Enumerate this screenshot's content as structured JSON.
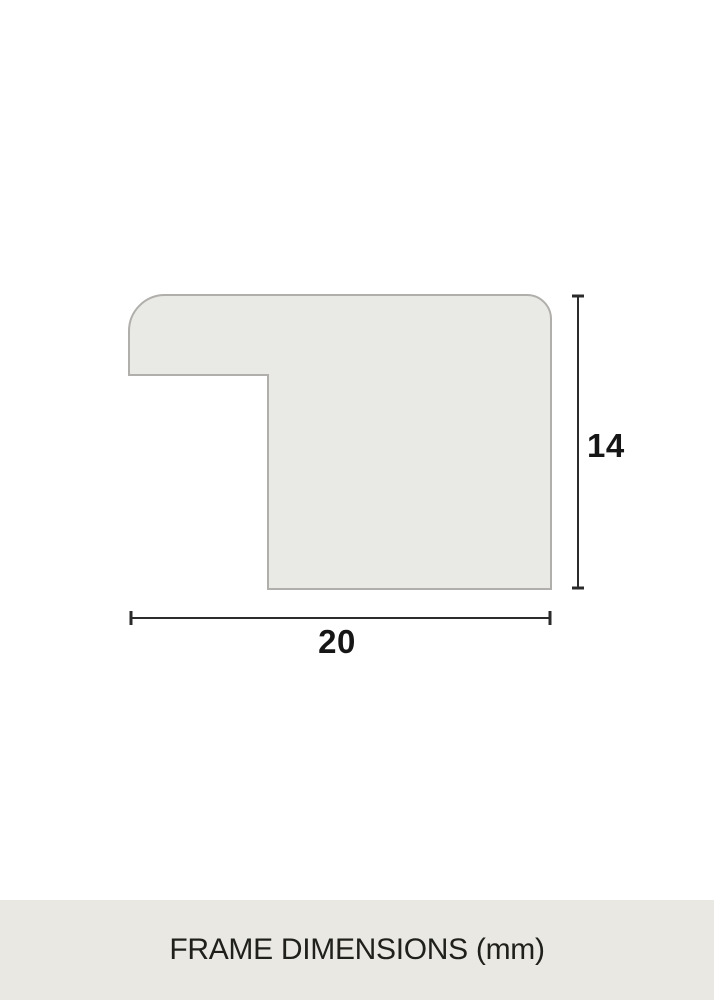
{
  "diagram": {
    "title": "frame-profile-cross-section",
    "width_label": "20",
    "height_label": "14",
    "width_value_mm": 20,
    "height_value_mm": 14,
    "unit": "mm"
  },
  "footer": {
    "caption": "FRAME DIMENSIONS (mm)"
  },
  "colors": {
    "background": "#ffffff",
    "shape_fill": "#e9e9e6",
    "shape_stroke": "#b1afac",
    "dimension_line": "#2b2b2b",
    "label_text": "#161616",
    "footer_background": "#e9e8e2",
    "footer_text": "#1f1f1c"
  }
}
